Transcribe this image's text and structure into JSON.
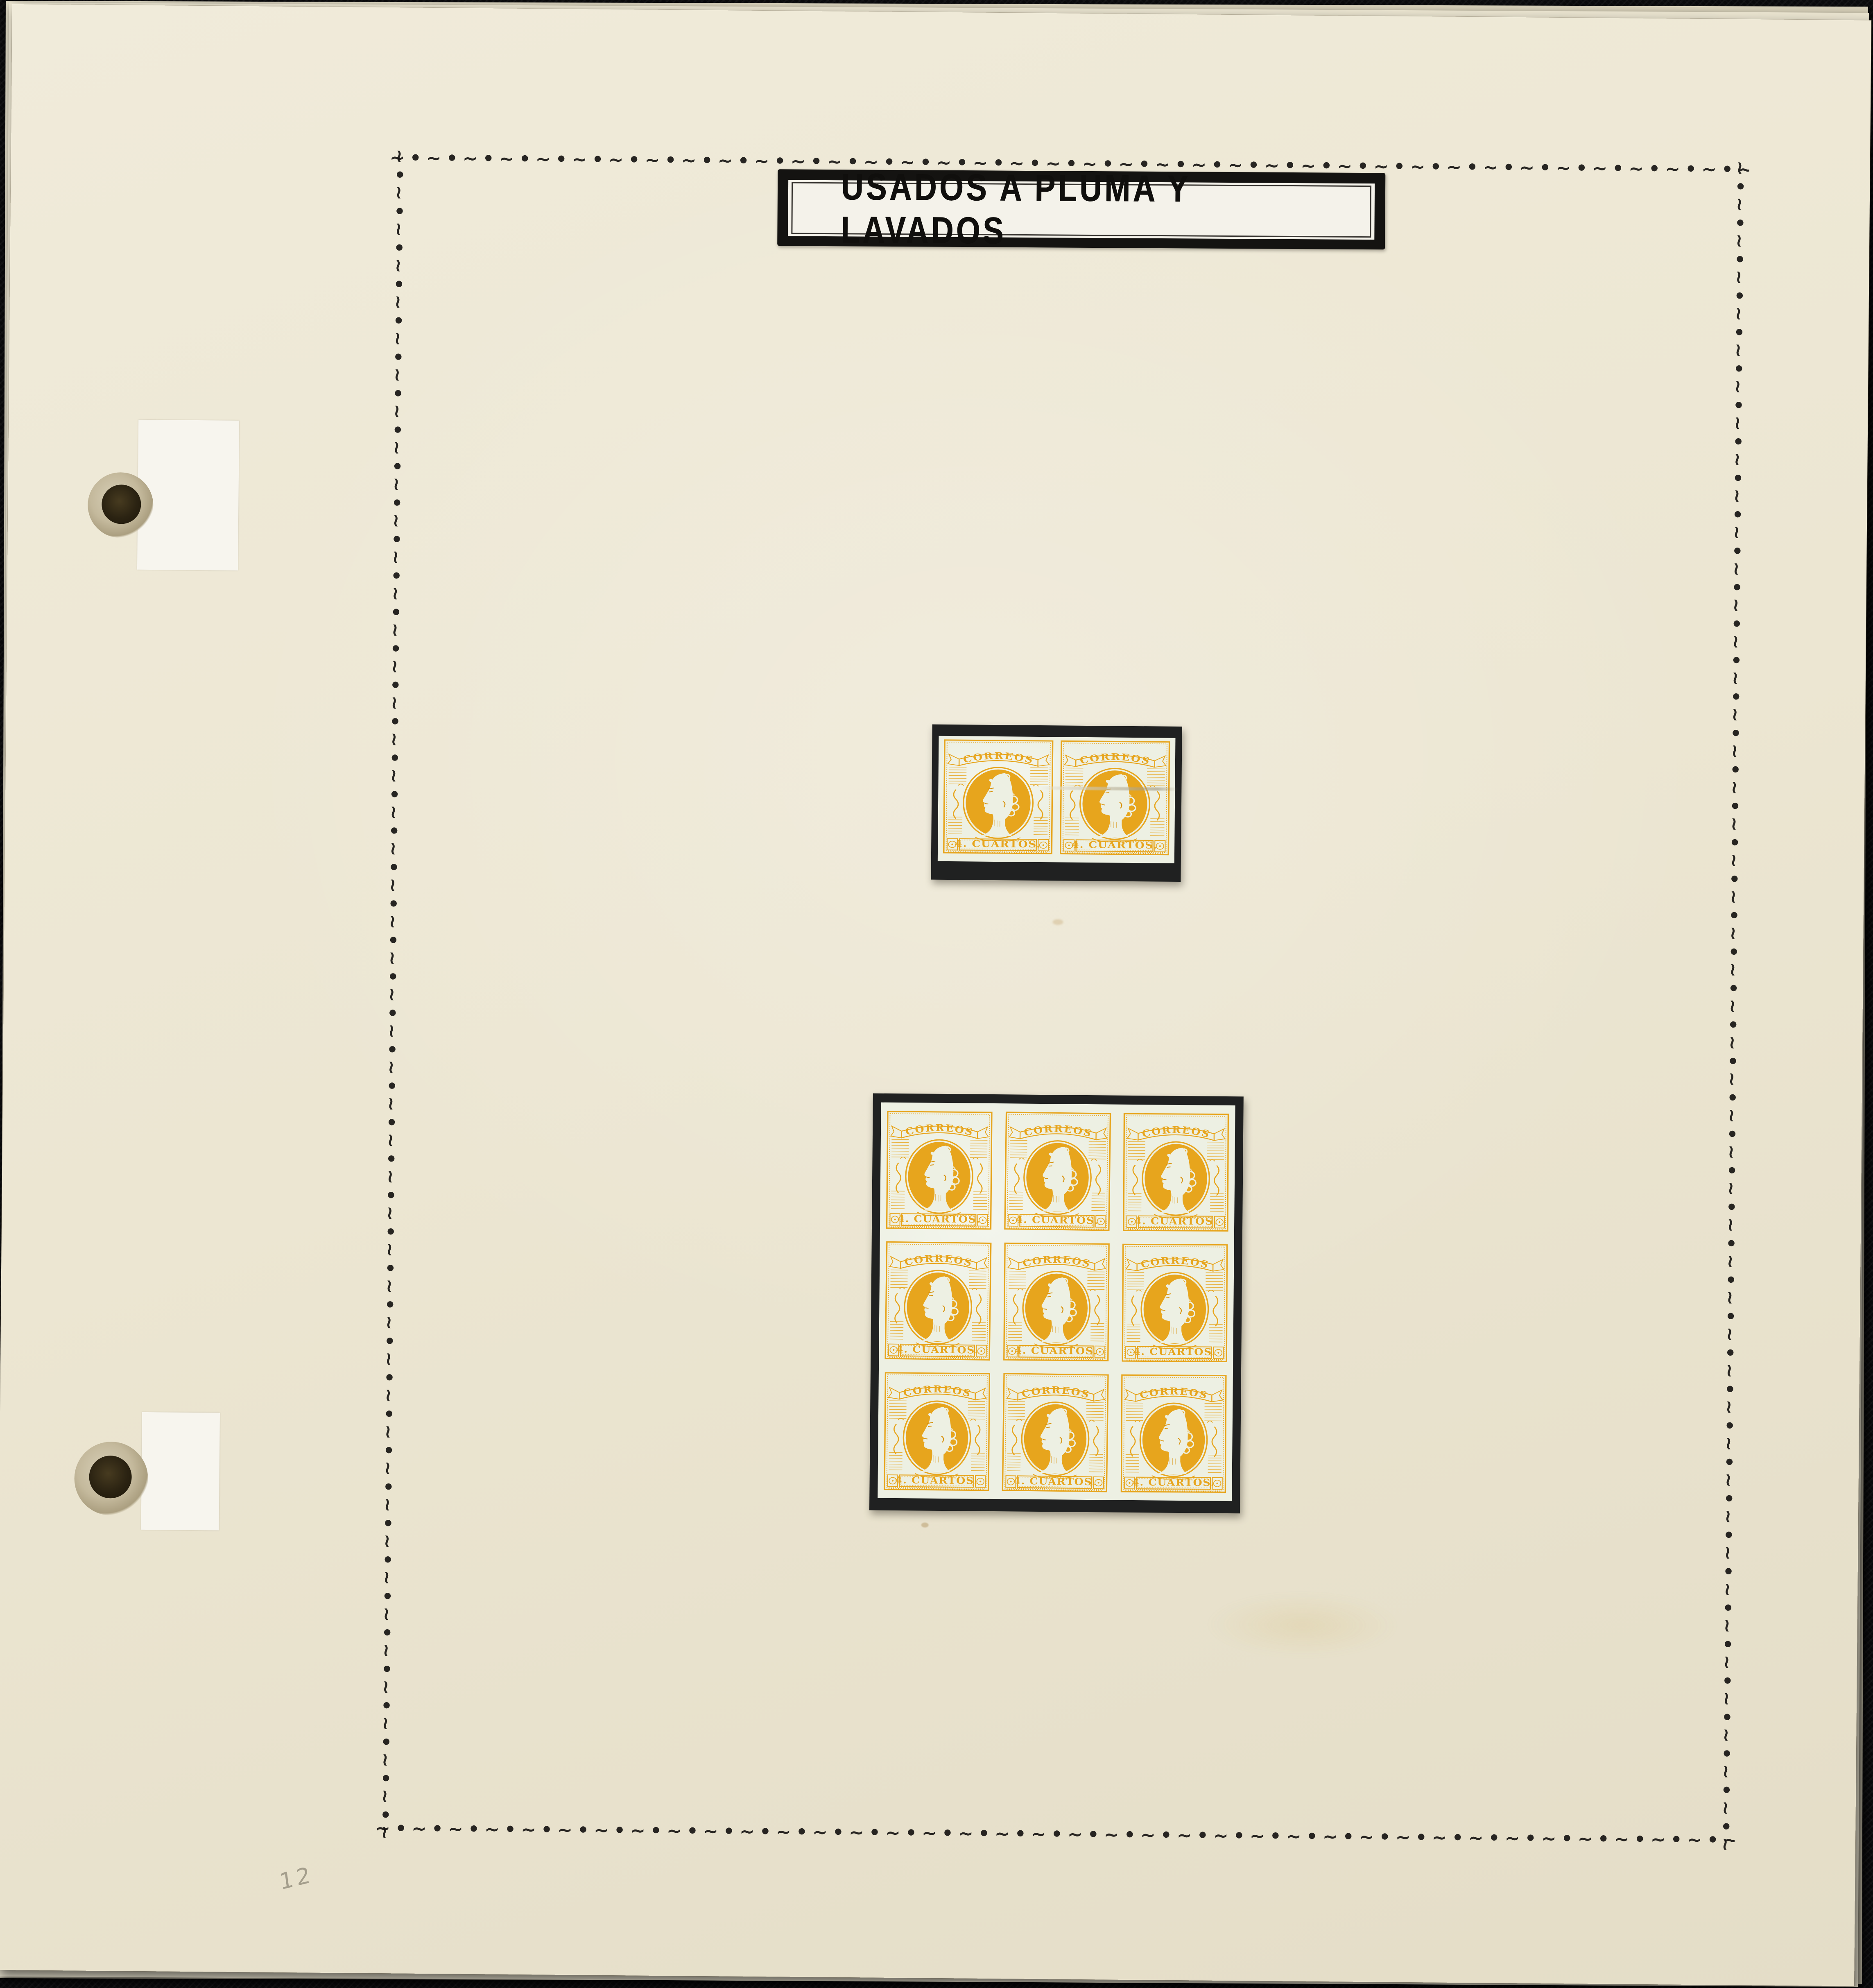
{
  "photo": {
    "description": "Photograph of a stamp album page lying on dark fabric",
    "page_title": "USADOS A PLUMA Y LAVADOS",
    "pencil_note": "12"
  },
  "stamp": {
    "inscription_top": "CORREOS",
    "denomination": "4. CUARTOS.",
    "design": "Queen Isabel II profile facing left within oval, Spain 1860 issue",
    "ink_color": "#e7a51d",
    "paper_color": "#edf0e3"
  },
  "stamp_groups": [
    {
      "name": "horizontal-pair",
      "rows": 1,
      "cols": 2,
      "count": 2
    },
    {
      "name": "block-of-nine",
      "rows": 3,
      "cols": 3,
      "count": 9
    }
  ],
  "border": {
    "ornament_unit": "∼•",
    "color": "#171513"
  },
  "colors": {
    "backdrop": "#0b0b0d",
    "page": "#ece6d2",
    "label_white": "#f4f2ea",
    "frame_black": "#141311",
    "mount_black": "#202121",
    "pencil_gray": "#a49e8c"
  }
}
